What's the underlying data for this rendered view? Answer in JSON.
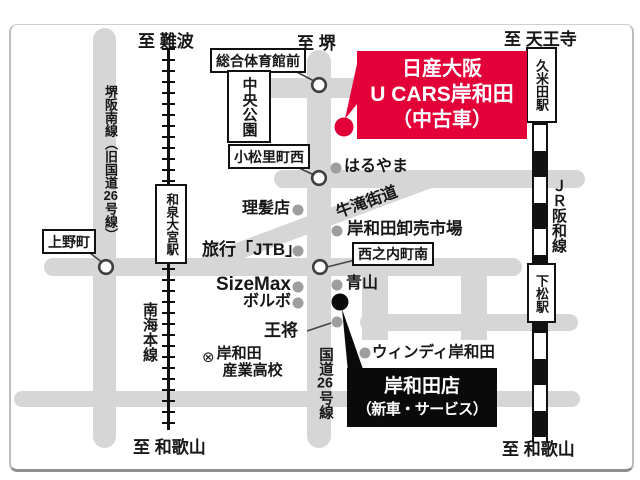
{
  "edge_labels": {
    "to_namba": "至 難波",
    "to_sakai": "至 堺",
    "to_tennoji": "至 天王寺",
    "to_wakayama_left": "至 和歌山",
    "to_wakayama_right": "至 和歌山"
  },
  "roads": {
    "sakai_hannan": {
      "p1": "堺阪南線（旧国道",
      "p2": "26",
      "p3": "号線）"
    },
    "route26": {
      "p1": "国道",
      "p2": "26",
      "p3": "号線"
    },
    "ushitaki_kaido": "牛滝街道"
  },
  "railways": {
    "nankai_line": "南海本線",
    "jr_hanwa_line": "ＪＲ阪和線"
  },
  "stations": {
    "kumeda": "久米田駅",
    "izumi_omiya": "和泉大宮駅",
    "shimomatsu": "下松駅"
  },
  "junction_labels": {
    "sogo_taiikukan_mae": "総合体育館前",
    "chuo_koen": "中央公園",
    "komatsuri_cho_nishi": "小松里町西",
    "ueno_cho": "上野町",
    "nishinouchi_cho_minami": "西之内町南"
  },
  "pois": {
    "haruyama": "はるやま",
    "rihatsuten": "理髪店",
    "oroshiuri_ichiba": "岸和田卸売市場",
    "jtb": "旅行「JTB」",
    "sizemax": "SizeMax",
    "volvo": "ボルボ",
    "aoyama": "青山",
    "ohsho": "王将",
    "windy_kishiwada": "ウィンディ岸和田",
    "school_symbol": "⊗",
    "school_line1": "岸和田",
    "school_line2": "産業高校"
  },
  "dealer_box": {
    "line1": "日産大阪",
    "line2": "U CARS岸和田",
    "line3": "（中古車）"
  },
  "branch_box": {
    "line1": "岸和田店",
    "line2": "（新車・サービス）"
  },
  "colors": {
    "accent_red": "#e30039",
    "road_gray": "#d6d6d6",
    "dot_gray": "#9e9e9e",
    "ink": "#171717"
  }
}
